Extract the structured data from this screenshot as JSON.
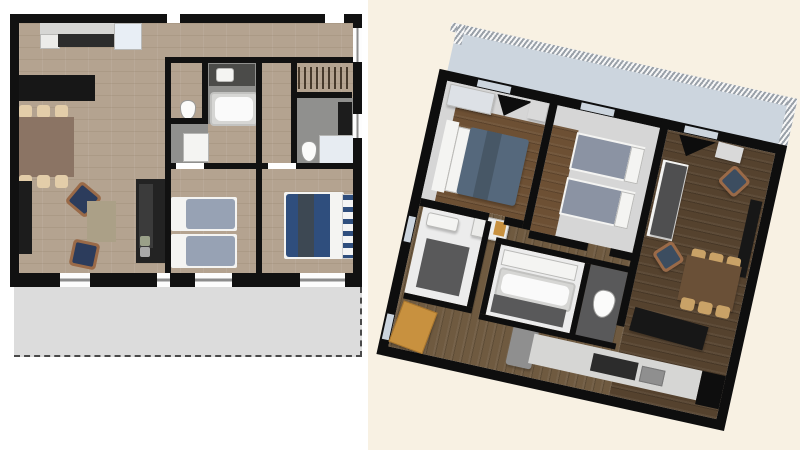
{
  "scene": {
    "description": "Two renderings of the same three-bedroom apartment floor plan shown side by side",
    "left_view": "2D top-down floor plan on white background",
    "right_view": "3D aerial dollhouse view rotated clockwise on cream background",
    "rotation_deg_right_view": 12.5
  },
  "palette": {
    "page_bg_left": "#ffffff",
    "page_bg_right": "#f8f1e3",
    "wall": "#111111",
    "wall3d": "#0e0e0e",
    "wood_floor_2d": "#b4a390",
    "wood_bedroom_3d": "#6d5034",
    "wood_living_3d": "#55422e",
    "wood_hall_3d": "#6f5a40",
    "tile_gray": "#90908e",
    "tile_dark": "#59595a",
    "balcony_2d": "#dcdcdc",
    "balcony_3d": "#ccd5de",
    "counter_top": "#d6d6d4",
    "counter_white": "#ececea",
    "counter_dark": "#2c2c2c",
    "fridge_2d": "#e8eef5",
    "fridge_3d": "#8f8f8f",
    "island_black": "#171717",
    "table_2d": "#8b7464",
    "table_3d": "#6a5037",
    "chair_2d": "#e3cda9",
    "chair_3d": "#c9a267",
    "armchair_navy": "#2c3c5c",
    "armchair_navy_3d": "#3c4d60",
    "armchair_frame": "#9a6a48",
    "rug": "#aba087",
    "sofa_2d": "#232323",
    "sofa_cushion_2d": "#3b3b3b",
    "sofa_3d": "#4f4f50",
    "sideboard": "#1c1c1c",
    "vanity_dark": "#4b4b49",
    "bed_single_2d": "#97a2b4",
    "bed_single_3d": "#8b93a3",
    "bed_double_2d": "#2f4e7d",
    "bed_double_3d": "#55687c",
    "throw_dark": "#3d4853",
    "fixture_white": "#f4f4f2",
    "shower_glass": "#e7ecf2",
    "room_gray_3d": "#d6d6d6",
    "bath_floor_3d": "#ececec",
    "wardrobe_3d": "#dde1e6",
    "shelf_white_3d": "#d9d9d9",
    "bench_orange": "#c8913f",
    "pillow_green": "#9aa089",
    "pillow_gray": "#a8a8a8"
  },
  "left_plan": {
    "view": "2d-top-down",
    "rooms": [
      "open living / dining / kitchen",
      "wc",
      "bathroom with bathtub",
      "shower room",
      "entry hall",
      "wardrobe closet",
      "shower room with wc",
      "twin bedroom",
      "double bedroom",
      "balcony terrace"
    ],
    "furniture": {
      "kitchen": [
        "wall counter with cabinets",
        "fridge",
        "black kitchen island"
      ],
      "dining": [
        "rectangular table",
        "6 chairs"
      ],
      "living": [
        "2 navy armchairs",
        "area rug",
        "dark sofa with cushions",
        "sideboard"
      ],
      "bathrooms": [
        "toilet",
        "dark vanity with sink",
        "bathtub",
        "shower tray",
        "second toilet",
        "glass shower",
        "tall cabinet"
      ],
      "twin_bedroom": [
        "2 single beds"
      ],
      "double_bedroom": [
        "double bed with navy duvet and dark throw",
        "striped bench"
      ]
    }
  },
  "right_plan": {
    "view": "3d-aerial-rotated",
    "rotation_deg": 12.5,
    "rooms": [
      "double bedroom",
      "twin bedroom",
      "living / dining room",
      "kitchen",
      "bathroom",
      "bathroom with bathtub",
      "wc",
      "entry hall",
      "balcony with railing"
    ],
    "furniture": {
      "double_bedroom": [
        "double bed",
        "wardrobe",
        "black tv panel"
      ],
      "twin_bedroom": [
        "2 single beds"
      ],
      "living": [
        "gray sofa",
        "2 navy armchairs",
        "dining table with 6 chairs",
        "black island",
        "media cabinet"
      ],
      "kitchen": [
        "counter with cooktop and sink",
        "fridge"
      ],
      "hall": [
        "wooden bench",
        "shoe cabinet with orange box"
      ]
    }
  }
}
